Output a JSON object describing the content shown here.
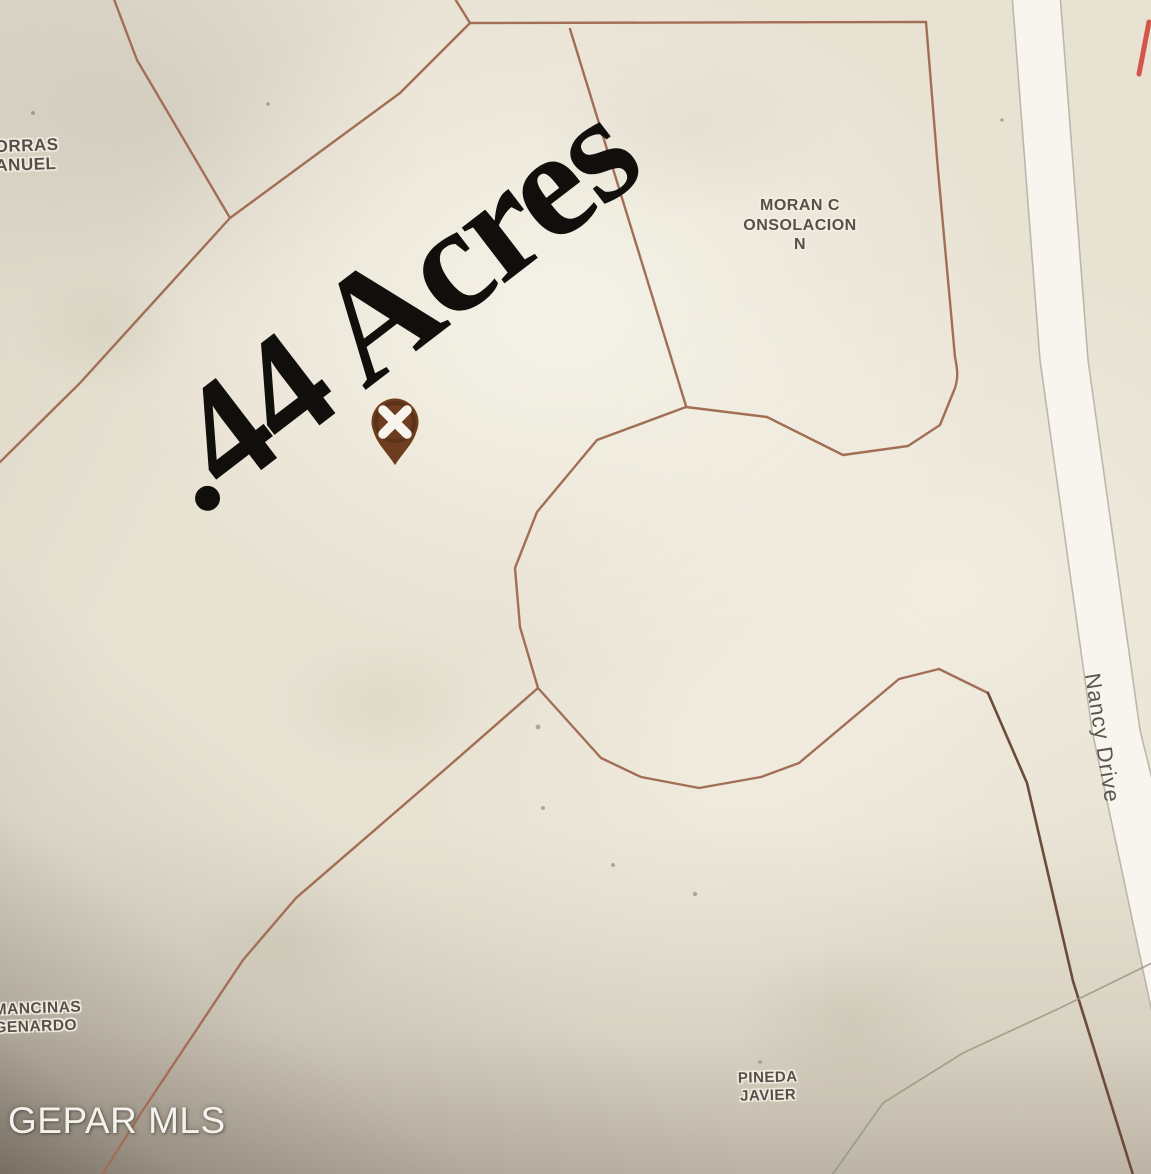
{
  "map": {
    "area_overlay": ".44 Acres",
    "watermark": "GEPAR MLS",
    "road_label": "Nancy Drive",
    "marker_icon": "x-pin-marker-icon",
    "parcels": {
      "porras": {
        "line1": "ORRAS",
        "line2": "ANUEL"
      },
      "moran": {
        "line1": "MORAN C",
        "line2": "ONSOLACION",
        "line3": "N"
      },
      "mancinas": {
        "line1": "MANCINAS",
        "line2": "GENARDO"
      },
      "pineda": {
        "line1": "PINEDA",
        "line2": "JAVIER"
      }
    },
    "colors": {
      "parcel_line": "#a26f56",
      "parcel_line_dark": "#6d4a3a",
      "road_fill": "#f7f5ee",
      "road_edge": "#b2aea1",
      "faint_line": "#98927f",
      "red_mark": "#d0453a",
      "label_text": "#54504a",
      "road_label_text": "#5a564e",
      "area_text": "#100f0c",
      "watermark_text": "#f4f2ec",
      "marker_fill": "#6e3d20",
      "marker_ring": "#4e2a12",
      "marker_halo": "#f2ead9",
      "marker_x": "#f7f4ee"
    }
  }
}
